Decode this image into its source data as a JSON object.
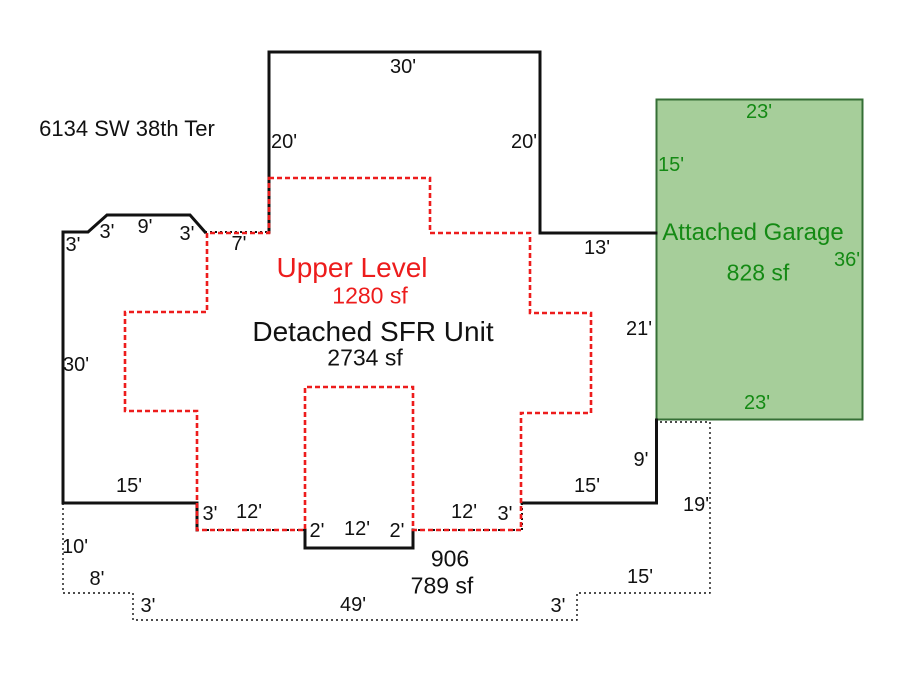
{
  "address": "6134 SW 38th Ter",
  "colors": {
    "ink": "#111111",
    "red": "#ed1c1c",
    "garage-fill": "#a6ce9a",
    "garage-border": "#356f35",
    "garage-text": "#148a14"
  },
  "sfr": {
    "name": "Detached SFR Unit",
    "area": "2734 sf",
    "dims": {
      "top": "30'",
      "upper_left": "20'",
      "upper_right": "20'",
      "step": "13'",
      "right_mid": "21'",
      "right_low": "9'",
      "bottom_right": "15'",
      "notch_r_v": "3'",
      "notch_r_h": "12'",
      "bump_r": "2'",
      "bump_b": "12'",
      "bump_l": "2'",
      "notch_l_h": "12'",
      "notch_l_v": "3'",
      "bottom_left": "15'",
      "left": "30'",
      "corner_v": "3'",
      "corner_d1": "3'",
      "corner_t": "9'",
      "corner_d2": "3'",
      "porch": "7'"
    }
  },
  "upper": {
    "name": "Upper Level",
    "area": "1280 sf"
  },
  "garage": {
    "name": "Attached Garage",
    "area": "828 sf",
    "dims": {
      "top": "23'",
      "left": "15'",
      "right": "36'",
      "bottom": "23'"
    }
  },
  "patio": {
    "name": "906",
    "area": "789 sf",
    "dims": {
      "left_v": "10'",
      "left_h": "8'",
      "step_l": "3'",
      "bottom": "49'",
      "step_r": "3'",
      "right_h": "15'",
      "right_v": "19'"
    }
  }
}
